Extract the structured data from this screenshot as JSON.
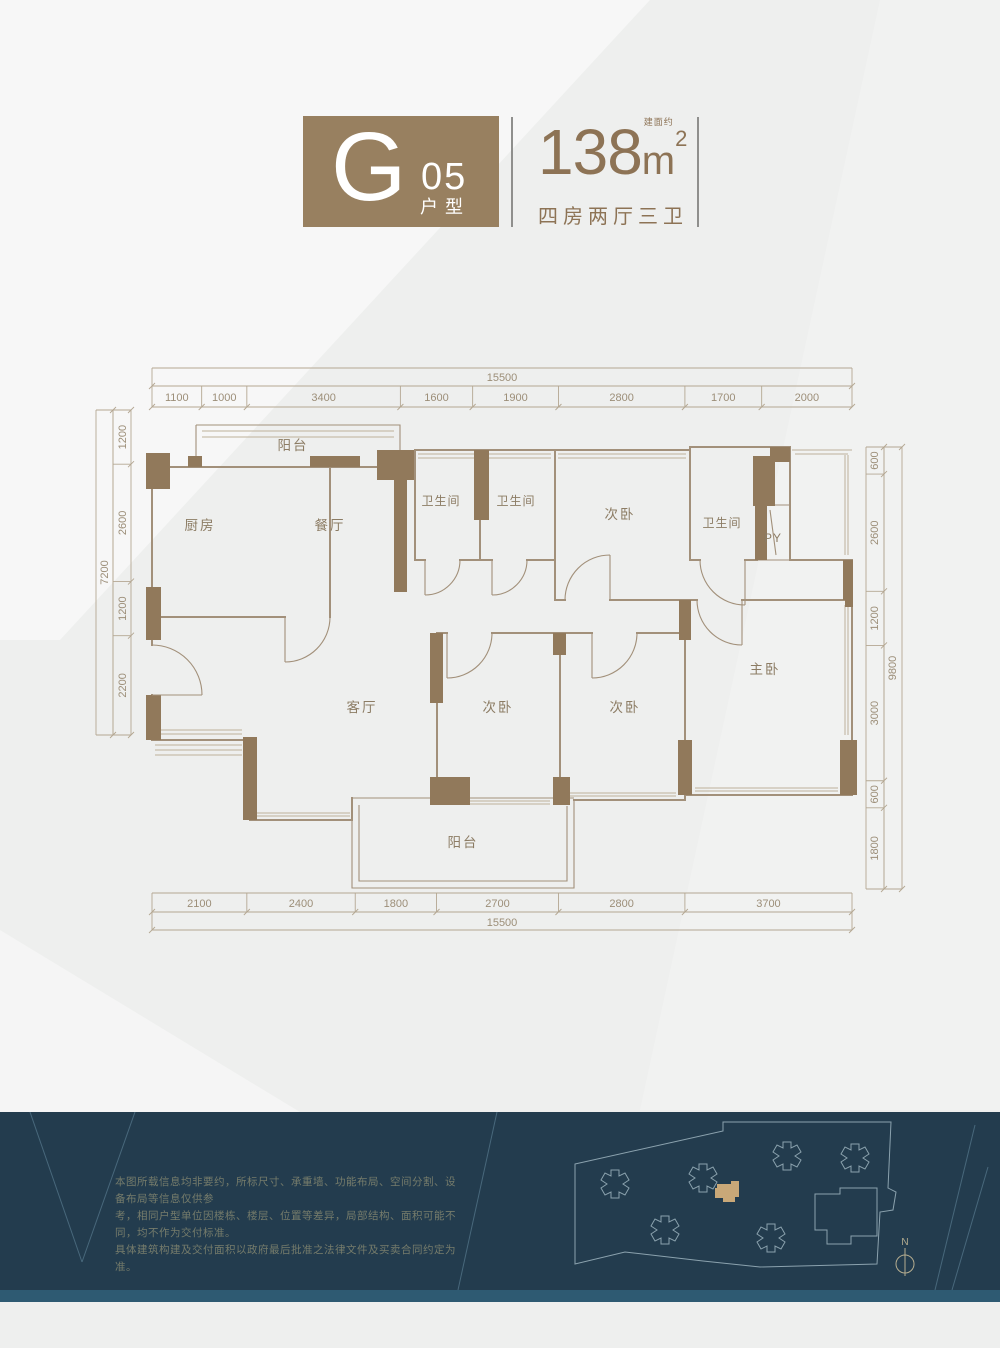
{
  "header": {
    "letter": "G",
    "number": "05",
    "type_label": "户型",
    "area_prefix": "建面约",
    "area_value": "138",
    "area_unit": "m",
    "area_exponent": "2",
    "layout_label": "四房两厅三卫"
  },
  "plan": {
    "rooms": [
      {
        "label": "阳台",
        "x": 293,
        "y": 450
      },
      {
        "label": "厨房",
        "x": 200,
        "y": 530
      },
      {
        "label": "餐厅",
        "x": 330,
        "y": 530
      },
      {
        "label": "卫生间",
        "x": 441,
        "y": 505,
        "small": true
      },
      {
        "label": "卫生间",
        "x": 516,
        "y": 505,
        "small": true
      },
      {
        "label": "次卧",
        "x": 620,
        "y": 519
      },
      {
        "label": "卫生间",
        "x": 722,
        "y": 527,
        "small": true
      },
      {
        "label": "PY",
        "x": 773,
        "y": 542,
        "small": true
      },
      {
        "label": "主卧",
        "x": 765,
        "y": 674
      },
      {
        "label": "客厅",
        "x": 362,
        "y": 712
      },
      {
        "label": "次卧",
        "x": 498,
        "y": 712
      },
      {
        "label": "次卧",
        "x": 625,
        "y": 712
      },
      {
        "label": "阳台",
        "x": 463,
        "y": 847
      }
    ],
    "dim_chains": [
      {
        "id": "top-total",
        "orient": "h",
        "x1": 152,
        "x2": 852,
        "l1": 368,
        "l2": 386,
        "t": 381,
        "segments": [
          {
            "label": "15500",
            "mm": 15500
          }
        ]
      },
      {
        "id": "top-segments",
        "orient": "h",
        "x1": 152,
        "x2": 852,
        "l1": 386,
        "l2": 407,
        "t": 401,
        "segments": [
          {
            "label": "1100",
            "mm": 1100
          },
          {
            "label": "1000",
            "mm": 1000
          },
          {
            "label": "3400",
            "mm": 3400
          },
          {
            "label": "1600",
            "mm": 1600
          },
          {
            "label": "1900",
            "mm": 1900
          },
          {
            "label": "2800",
            "mm": 2800
          },
          {
            "label": "1700",
            "mm": 1700
          },
          {
            "label": "2000",
            "mm": 2000
          }
        ]
      },
      {
        "id": "bottom-segments",
        "orient": "h",
        "x1": 152,
        "x2": 852,
        "l1": 893,
        "l2": 912,
        "t": 907,
        "segments": [
          {
            "label": "2100",
            "mm": 2100
          },
          {
            "label": "2400",
            "mm": 2400
          },
          {
            "label": "1800",
            "mm": 1800
          },
          {
            "label": "2700",
            "mm": 2700
          },
          {
            "label": "2800",
            "mm": 2800
          },
          {
            "label": "3700",
            "mm": 3700
          }
        ]
      },
      {
        "id": "bottom-total",
        "orient": "h",
        "x1": 152,
        "x2": 852,
        "l1": 912,
        "l2": 930,
        "t": 926,
        "segments": [
          {
            "label": "15500",
            "mm": 15500
          }
        ]
      },
      {
        "id": "left-total",
        "orient": "v",
        "y1": 410,
        "y2": 735,
        "l1": 96,
        "l2": 113,
        "t": 108,
        "segments": [
          {
            "label": "7200",
            "mm": 7200
          }
        ]
      },
      {
        "id": "left-segments",
        "orient": "v",
        "y1": 410,
        "y2": 735,
        "l1": 113,
        "l2": 131,
        "t": 126,
        "segments": [
          {
            "label": "1200",
            "mm": 1200
          },
          {
            "label": "2600",
            "mm": 2600
          },
          {
            "label": "1200",
            "mm": 1200
          },
          {
            "label": "2200",
            "mm": 2200
          }
        ]
      },
      {
        "id": "right-segments",
        "orient": "v",
        "y1": 447,
        "y2": 889,
        "l1": 866,
        "l2": 884,
        "t": 878,
        "segments": [
          {
            "label": "600",
            "mm": 600
          },
          {
            "label": "2600",
            "mm": 2600
          },
          {
            "label": "1200",
            "mm": 1200
          },
          {
            "label": "3000",
            "mm": 3000
          },
          {
            "label": "600",
            "mm": 600
          },
          {
            "label": "1800",
            "mm": 1800
          }
        ]
      },
      {
        "id": "right-total",
        "orient": "v",
        "y1": 447,
        "y2": 889,
        "l1": 884,
        "l2": 902,
        "t": 896,
        "segments": [
          {
            "label": "9800",
            "mm": 9800
          }
        ]
      }
    ]
  },
  "footer": {
    "disclaimer_lines": [
      "本图所载信息均非要约，所标尺寸、承重墙、功能布局、空间分割、设备布局等信息仅供参",
      "考，相同户型单位因楼栋、楼层、位置等差异，局部结构、面积可能不同，均不作为交付标准。",
      "具体建筑构建及交付面积以政府最后批准之法律文件及买卖合同约定为准。"
    ],
    "compass_label": "N"
  },
  "colors": {
    "badge_bg": "#988060",
    "header_text": "#8d7355",
    "divider": "#8f8f8d",
    "wall_line": "#a2907a",
    "pillar": "#91795b",
    "window_line": "#bdb09a",
    "dim_line": "#b4a792",
    "dim_text": "#9c8e78",
    "room_text": "#8c7c64",
    "footer_bg": "#233c4e",
    "footer_strip": "#2e5a72",
    "footer_line": "#4f7084",
    "site_outline": "#8ba2ae",
    "site_highlight": "#c9a878",
    "compass": "#b5ad90",
    "disclaimer_text": "#767c6b"
  }
}
